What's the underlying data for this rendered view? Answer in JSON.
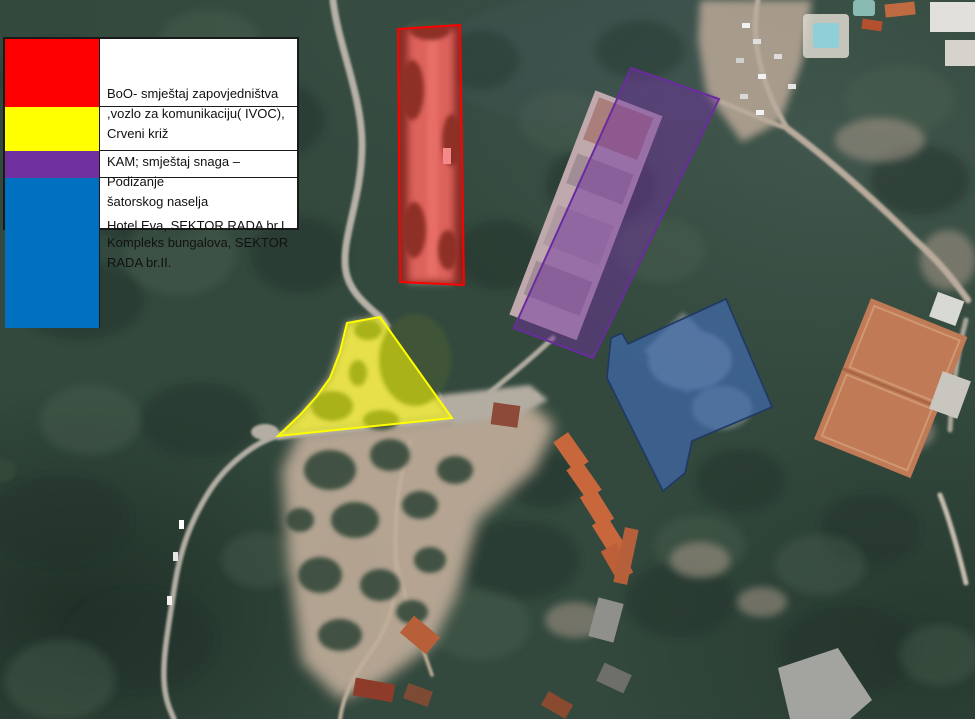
{
  "legend": {
    "items": [
      {
        "id": "boo",
        "color": "#ff0000",
        "label": "BoO- smještaj zapovjedništva\n,vozlo za komunikaciju( IVOC),\nCrveni križ"
      },
      {
        "id": "kam",
        "color": "#ffff00",
        "label": "KAM; smještaj snaga – Podizanje\nšatorskog naselja"
      },
      {
        "id": "hotel-eva",
        "color": "#7030a0",
        "label": "Hotel Eva, SEKTOR RADA br.I."
      },
      {
        "id": "bungalovi",
        "color": "#0070c0",
        "label": "Kompleks bungalova, SEKTOR\nRADA br.II."
      }
    ]
  },
  "overlays": {
    "boo": {
      "fill": "#ff0000"
    },
    "kam": {
      "fill": "#ffff00"
    },
    "hotel_eva": {
      "fill": "#7030a0"
    },
    "bungalovi": {
      "fill": "#4472c4"
    }
  }
}
